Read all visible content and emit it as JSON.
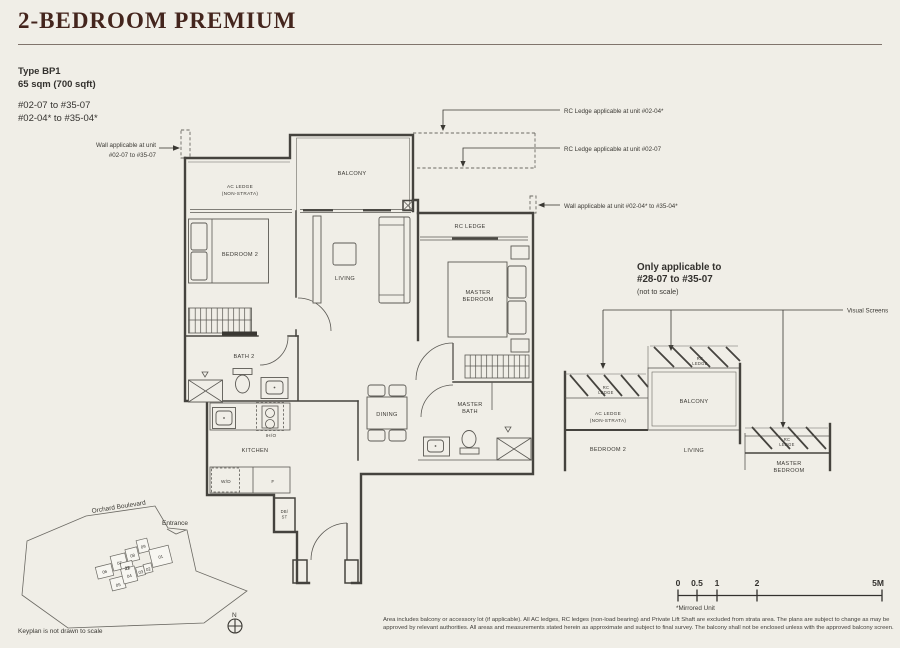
{
  "colors": {
    "background": "#f0eee7",
    "title": "#44251d",
    "wall": "#45433e",
    "highlight_green": "#a9bfb0"
  },
  "header": {
    "title": "2-BEDROOM PREMIUM",
    "type_label": "Type BP1",
    "area": "65 sqm (700 sqft)",
    "units": [
      "#02-07 to #35-07",
      "#02-04* to #35-04*"
    ]
  },
  "annotations": {
    "wall_left": [
      "Wall applicable at unit",
      "#02-07 to #35-07"
    ],
    "rc_ledge_04": "RC Ledge applicable at unit #02-04*",
    "rc_ledge_07": "RC Ledge applicable at unit #02-07",
    "wall_right": "Wall applicable at unit #02-04* to #35-04*"
  },
  "floorplan": {
    "labels": {
      "ac_ledge": "AC LEDGE",
      "ac_ledge_sub": "(NON-STRATA)",
      "balcony": "BALCONY",
      "rc_ledge": "RC LEDGE",
      "bedroom2": "BEDROOM 2",
      "living": "LIVING",
      "master_1": "MASTER",
      "master_2": "BEDROOM",
      "bath2": "BATH 2",
      "kitchen": "KITCHEN",
      "iho": "IH/O",
      "wd": "W/D",
      "f": "F",
      "db1": "DB/",
      "db2": "ST",
      "dining": "DINING",
      "mbath_1": "MASTER",
      "mbath_2": "BATH"
    }
  },
  "section": {
    "title": [
      "Only applicable to",
      "#28-07 to #35-07"
    ],
    "note": "(not to scale)",
    "visual_screens": "Visual Screens",
    "rc": "RC",
    "ledge": "LEDGE",
    "ac1": "AC LEDGE",
    "ac2": "(NON-STRATA)",
    "bedroom2": "BEDROOM 2",
    "balcony": "BALCONY",
    "living": "LIVING",
    "master1": "MASTER",
    "master2": "BEDROOM"
  },
  "keyplan": {
    "road": "Orchard Boulevard",
    "entrance": "Entrance",
    "note": "Keyplan is not drawn to scale",
    "north": "N",
    "highlight_color": "#a9bfb0",
    "blocks": [
      {
        "label": "06",
        "highlight": false
      },
      {
        "label": "07",
        "highlight": true
      },
      {
        "label": "08",
        "highlight": false
      },
      {
        "label": "09",
        "highlight": false
      },
      {
        "label": "22",
        "highlight": false
      },
      {
        "label": "01",
        "highlight": false
      },
      {
        "label": "05",
        "highlight": false
      },
      {
        "label": "04",
        "highlight": true
      },
      {
        "label": "03",
        "highlight": false
      },
      {
        "label": "02",
        "highlight": false
      }
    ]
  },
  "scalebar": {
    "labels": [
      "0",
      "0.5",
      "1",
      "2",
      "5M"
    ],
    "mirrored": "*Mirrored Unit"
  },
  "disclaimer": {
    "text": "Area includes balcony or accessory lot (if applicable). All AC ledges, RC ledges (non-load bearing) and Private Lift Shaft are excluded from strata area. The plans are subject to change as may be approved by relevant authorities. All areas and measurements stated herein as approximate and subject to final survey. The balcony shall not be enclosed unless with the approved balcony screen."
  }
}
